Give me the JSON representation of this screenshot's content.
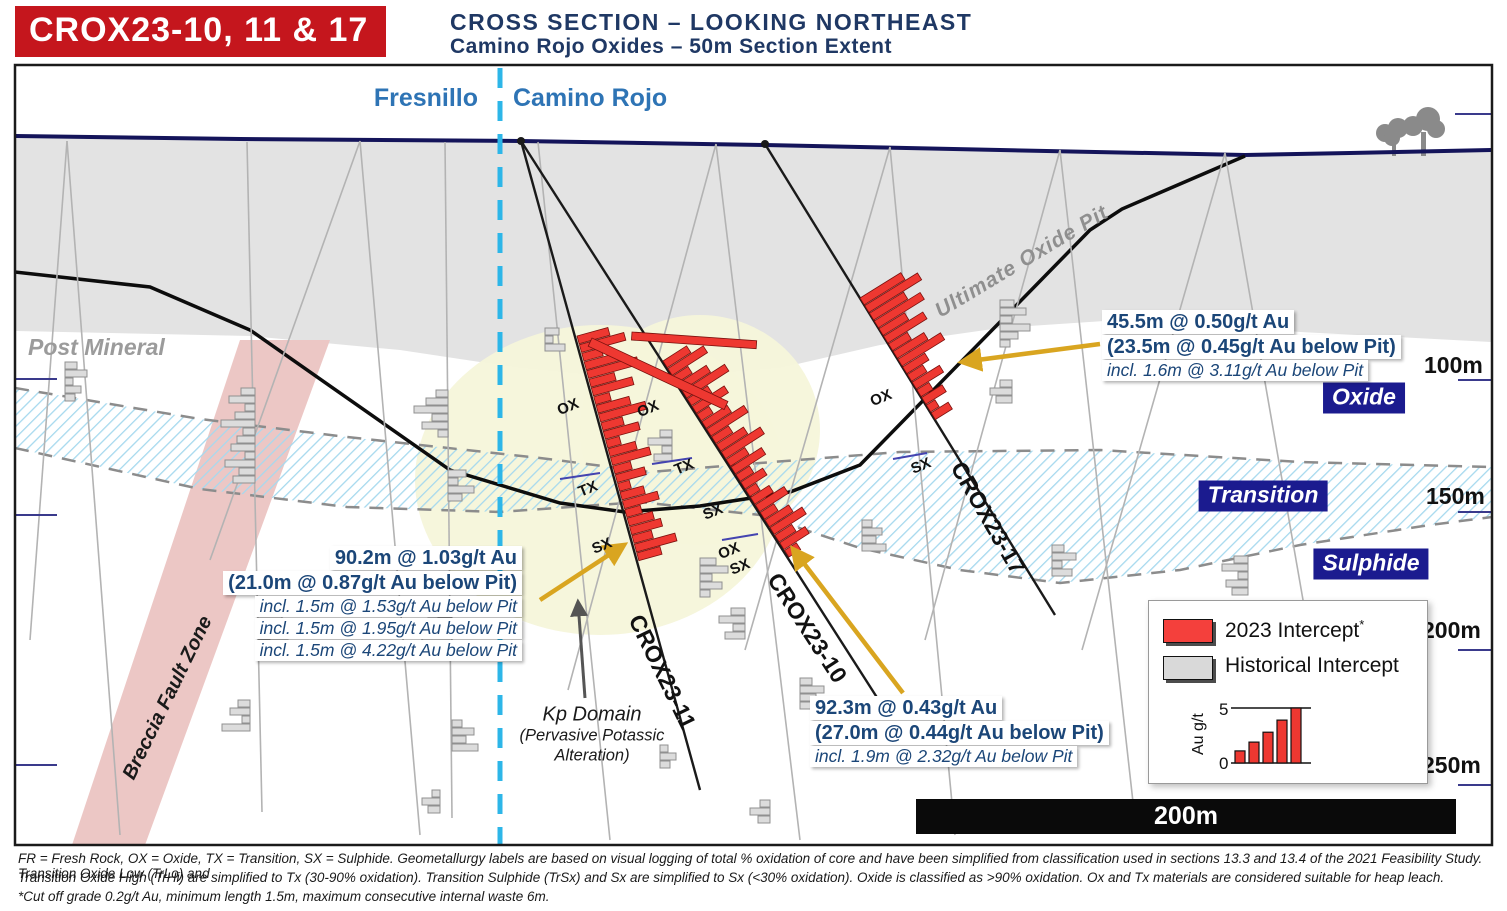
{
  "header": {
    "badge": "CROX23-10, 11 & 17",
    "title": "CROSS SECTION – LOOKING NORTHEAST",
    "subtitle": "Camino Rojo Oxides – 50m Section Extent"
  },
  "boundary": {
    "left_property": "Fresnillo",
    "right_property": "Camino Rojo"
  },
  "region_labels": {
    "post_mineral": "Post Mineral",
    "breccia_fault": "Breccia Fault Zone",
    "ultimate_pit": "Ultimate Oxide Pit",
    "kp_domain": "Kp Domain",
    "kp_sub1": "(Pervasive Potassic",
    "kp_sub2": "Alteration)"
  },
  "zones": {
    "oxide": "Oxide",
    "transition": "Transition",
    "sulphide": "Sulphide"
  },
  "depths": [
    "100m",
    "150m",
    "200m",
    "250m"
  ],
  "holes": {
    "h11": "CROX23-11",
    "h10": "CROX23-10",
    "h17": "CROX23-17"
  },
  "geomet": {
    "ox": "OX",
    "tx": "TX",
    "sx": "SX"
  },
  "annotations": {
    "a17": {
      "l1": "45.5m @ 0.50g/t Au",
      "l2": "(23.5m @ 0.45g/t Au below Pit)",
      "l3": "incl. 1.6m @ 3.11g/t Au below Pit"
    },
    "a11": {
      "l1": "90.2m @ 1.03g/t Au",
      "l2": "(21.0m @ 0.87g/t Au below Pit)",
      "l3": "incl. 1.5m @ 1.53g/t Au below Pit",
      "l4": "incl. 1.5m @ 1.95g/t Au below Pit",
      "l5": "incl. 1.5m @ 4.22g/t Au below Pit"
    },
    "a10": {
      "l1": "92.3m @ 0.43g/t Au",
      "l2": "(27.0m @ 0.44g/t Au below Pit)",
      "l3": "incl. 1.9m @ 2.32g/t Au below Pit"
    }
  },
  "legend": {
    "item1": "2023 Intercept",
    "item1_sup": "*",
    "item2": "Historical Intercept",
    "chart": {
      "type": "bar",
      "ylabel": "Au g/t",
      "ymin": "0",
      "ymax": "5",
      "values": [
        1.1,
        1.9,
        2.8,
        3.9,
        5
      ]
    }
  },
  "scalebar": "200m",
  "footnotes": {
    "line1": "FR = Fresh Rock, OX = Oxide, TX = Transition, SX = Sulphide. Geometallurgy labels are based on visual logging of total % oxidation of core and have been simplified from classification used in sections 13.3 and 13.4 of the 2021 Feasibility Study. Transition Oxide Low (TrLo) and",
    "line2": "Transition Oxide High (TrHi) are simplified to Tx (30-90% oxidation). Transition Sulphide (TrSx) and Sx are simplified to Sx (<30% oxidation). Oxide is classified as >90% oxidation. Ox and Tx materials are considered suitable for heap leach.",
    "line3": "*Cut off grade 0.2g/t Au, minimum length 1.5m, maximum consecutive internal waste 6m."
  },
  "colors": {
    "intercept_red": "#ee3831",
    "historical_gray": "#dcdcdc",
    "header_red": "#c5161d",
    "navy": "#1f3864",
    "property_blue": "#2e74b5",
    "boundary_cyan": "#2db6e8",
    "fault_pink": "#ecc7c5",
    "cover_gray": "#e3e3e3",
    "zone_badge_navy": "#1b1b8f",
    "arrow_gold": "#d9a520"
  },
  "historical_clusters": [
    {
      "x": 65,
      "y": 362,
      "d": 1,
      "w": [
        12,
        22,
        8,
        16,
        10
      ]
    },
    {
      "x": 255,
      "y": 388,
      "d": -1,
      "w": [
        14,
        26,
        10,
        20,
        34,
        12,
        18,
        24,
        10,
        30,
        16,
        22
      ]
    },
    {
      "x": 258,
      "y": 600,
      "d": 1,
      "w": [
        16,
        10,
        24,
        14,
        30,
        12
      ]
    },
    {
      "x": 250,
      "y": 700,
      "d": -1,
      "w": [
        12,
        20,
        8,
        28
      ]
    },
    {
      "x": 448,
      "y": 390,
      "d": -1,
      "w": [
        12,
        22,
        34,
        16,
        26,
        10
      ]
    },
    {
      "x": 448,
      "y": 470,
      "d": 1,
      "w": [
        18,
        10,
        26,
        14
      ]
    },
    {
      "x": 452,
      "y": 610,
      "d": -1,
      "w": [
        14,
        24,
        10,
        30,
        18
      ]
    },
    {
      "x": 452,
      "y": 720,
      "d": 1,
      "w": [
        10,
        22,
        14,
        26
      ]
    },
    {
      "x": 440,
      "y": 790,
      "d": -1,
      "w": [
        8,
        18,
        12
      ]
    },
    {
      "x": 545,
      "y": 328,
      "d": 1,
      "w": [
        14,
        8,
        20
      ]
    },
    {
      "x": 672,
      "y": 430,
      "d": -1,
      "w": [
        12,
        24,
        10,
        18
      ]
    },
    {
      "x": 700,
      "y": 558,
      "d": 1,
      "w": [
        16,
        28,
        12,
        22,
        10
      ]
    },
    {
      "x": 745,
      "y": 608,
      "d": -1,
      "w": [
        14,
        26,
        12,
        20
      ]
    },
    {
      "x": 800,
      "y": 678,
      "d": 1,
      "w": [
        12,
        24,
        16,
        30
      ]
    },
    {
      "x": 862,
      "y": 520,
      "d": 1,
      "w": [
        10,
        20,
        14,
        24
      ]
    },
    {
      "x": 1000,
      "y": 300,
      "d": 1,
      "w": [
        14,
        26,
        12,
        30,
        18,
        10
      ]
    },
    {
      "x": 1012,
      "y": 380,
      "d": -1,
      "w": [
        12,
        22,
        16
      ]
    },
    {
      "x": 1052,
      "y": 545,
      "d": 1,
      "w": [
        12,
        24,
        10,
        20
      ]
    },
    {
      "x": 1248,
      "y": 556,
      "d": -1,
      "w": [
        14,
        26,
        10,
        22,
        16
      ]
    },
    {
      "x": 770,
      "y": 800,
      "d": -1,
      "w": [
        10,
        20,
        12
      ]
    },
    {
      "x": 660,
      "y": 745,
      "d": 1,
      "w": [
        8,
        16,
        10
      ]
    }
  ],
  "red_intercepts": [
    {
      "x": 577,
      "y": 336,
      "a": 74.6,
      "h": [
        32,
        46,
        20,
        38,
        52,
        26,
        42,
        16,
        34,
        48,
        22,
        36,
        14,
        28,
        40,
        18,
        30,
        12,
        24,
        36,
        16,
        26,
        32,
        20,
        42,
        24
      ]
    },
    {
      "x": 663,
      "y": 361,
      "a": 57.3,
      "h": [
        28,
        42,
        18,
        34,
        50,
        24,
        38,
        14,
        30,
        44,
        20,
        32,
        46,
        22,
        36,
        16,
        26,
        12,
        22,
        34,
        16,
        28,
        38,
        20,
        30,
        14
      ]
    },
    {
      "x": 860,
      "y": 298,
      "a": 58.2,
      "h": [
        48,
        62,
        40,
        54,
        30,
        46,
        22,
        36,
        50,
        26,
        18,
        32,
        14,
        24,
        10,
        20
      ]
    }
  ]
}
